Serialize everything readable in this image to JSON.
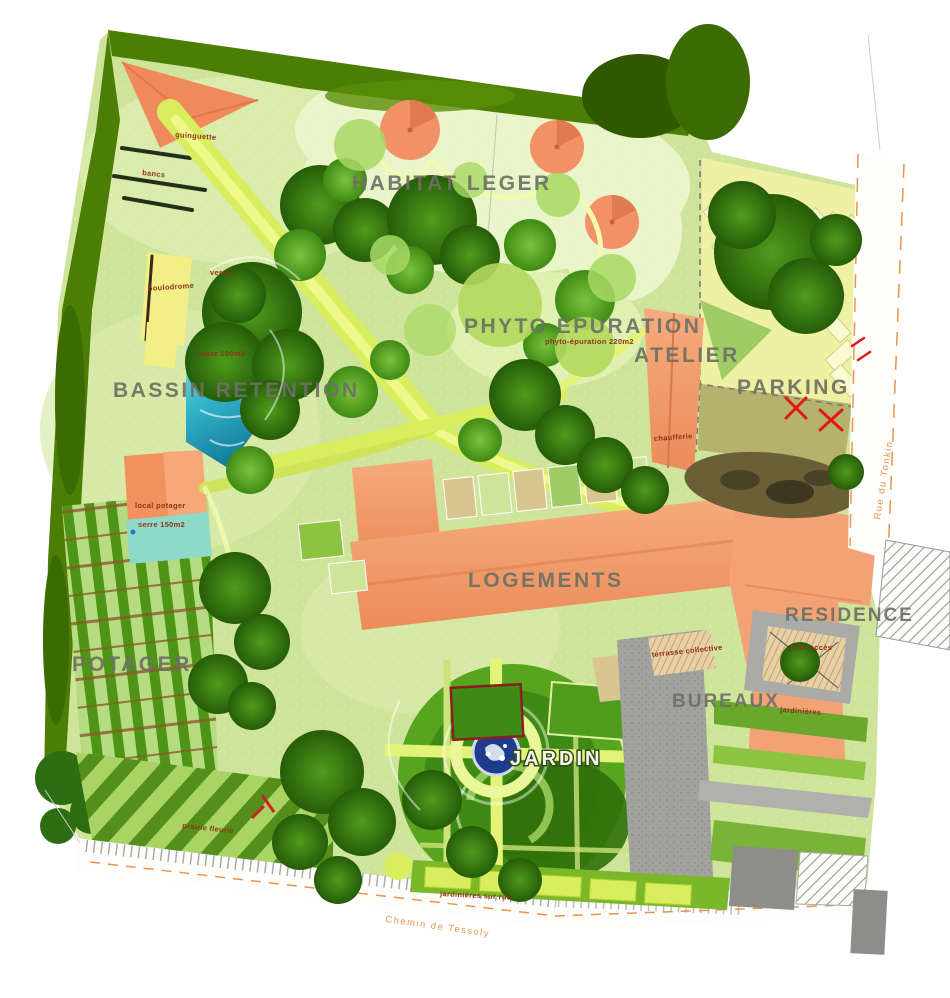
{
  "page": {
    "title": "Plan masse du site"
  },
  "map": {
    "zones": {
      "habitat_leger": "HABITAT LEGER",
      "phyto_epuration": "PHYTO EPURATION",
      "atelier": "ATELIER",
      "parking": "PARKING",
      "bassin_retention": "BASSIN RETENTION",
      "logements": "LOGEMENTS",
      "residence": "RESIDENCE",
      "potager": "POTAGER",
      "bureaux": "BUREAUX",
      "jardin": "JARDIN"
    },
    "features": {
      "guinguette": "guinguette",
      "bancs": "bancs",
      "verger": "verger",
      "boulodrome": "boulodrome",
      "mare": "mare 100m2",
      "phyto_surface": "phyto-épuration 220m2",
      "chaufferie": "chaufferie",
      "local_potager": "local potager",
      "serre": "serre 150m2",
      "terrasse_collective": "terrasse collective",
      "cour_acces": "cour accès",
      "jardinieres": "jardinières",
      "prairie_fleurie": "prairie fleurie",
      "jardinieres_sur_rue": "jardinières sur rue"
    },
    "streets": {
      "chemin_tessoly": "Chemin de Tessoly",
      "rue_tonkin": "Rue du Tonkin"
    },
    "colors": {
      "site_green": "#cfe49b",
      "path_yellow": "#d8ee5e",
      "building_orange": "#ef9465",
      "water_blue": "#36b8cd",
      "parking_yellow": "#eef0a2",
      "tree_dark": "#2d6e12",
      "paving_gray": "#a2a29e",
      "label_gray": "#6d7164",
      "note_red": "#8f3318",
      "street_orange": "#e8954f"
    }
  }
}
